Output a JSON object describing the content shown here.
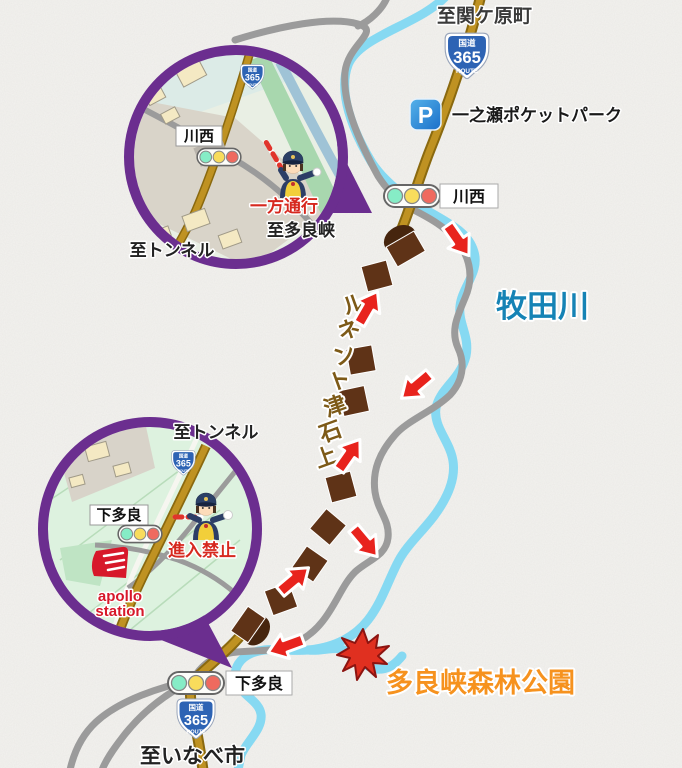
{
  "main": {
    "top_destination": "至関ケ原町",
    "bottom_destination": "至いなべ市",
    "parking_name": "一之瀬ポケットパーク",
    "parking_icon": "P",
    "river_name": "牧田川",
    "tunnel_label": "上石津トンネル",
    "park_name": "多良峡森林公園",
    "signal_kawanishi": "川西",
    "signal_shimotara": "下多良",
    "route_shield": {
      "prefix": "国道",
      "number": "365",
      "suffix": "ROUTE"
    }
  },
  "inset_top": {
    "signal_label": "川西",
    "warning": "一方通行",
    "dest_tunnel": "至トンネル",
    "dest_gorge": "至多良峡"
  },
  "inset_bottom": {
    "dest_tunnel": "至トンネル",
    "signal_label": "下多良",
    "warning": "進入禁止",
    "gas_station_line1": "apollo",
    "gas_station_line2": "station"
  },
  "colors": {
    "route_shield_blue": "#2d63b4",
    "route_road_khaki": "#bf9222",
    "river_blue": "#86d9f2",
    "arrow_red": "#e8231d",
    "tunnel_brown": "#5f3317",
    "inset_ring_purple": "#6b2e8f",
    "park_orange": "#f6921e",
    "river_label_blue": "#1583b5",
    "warning_red": "#d6281e",
    "parking_blue": "#1a6fc9"
  }
}
